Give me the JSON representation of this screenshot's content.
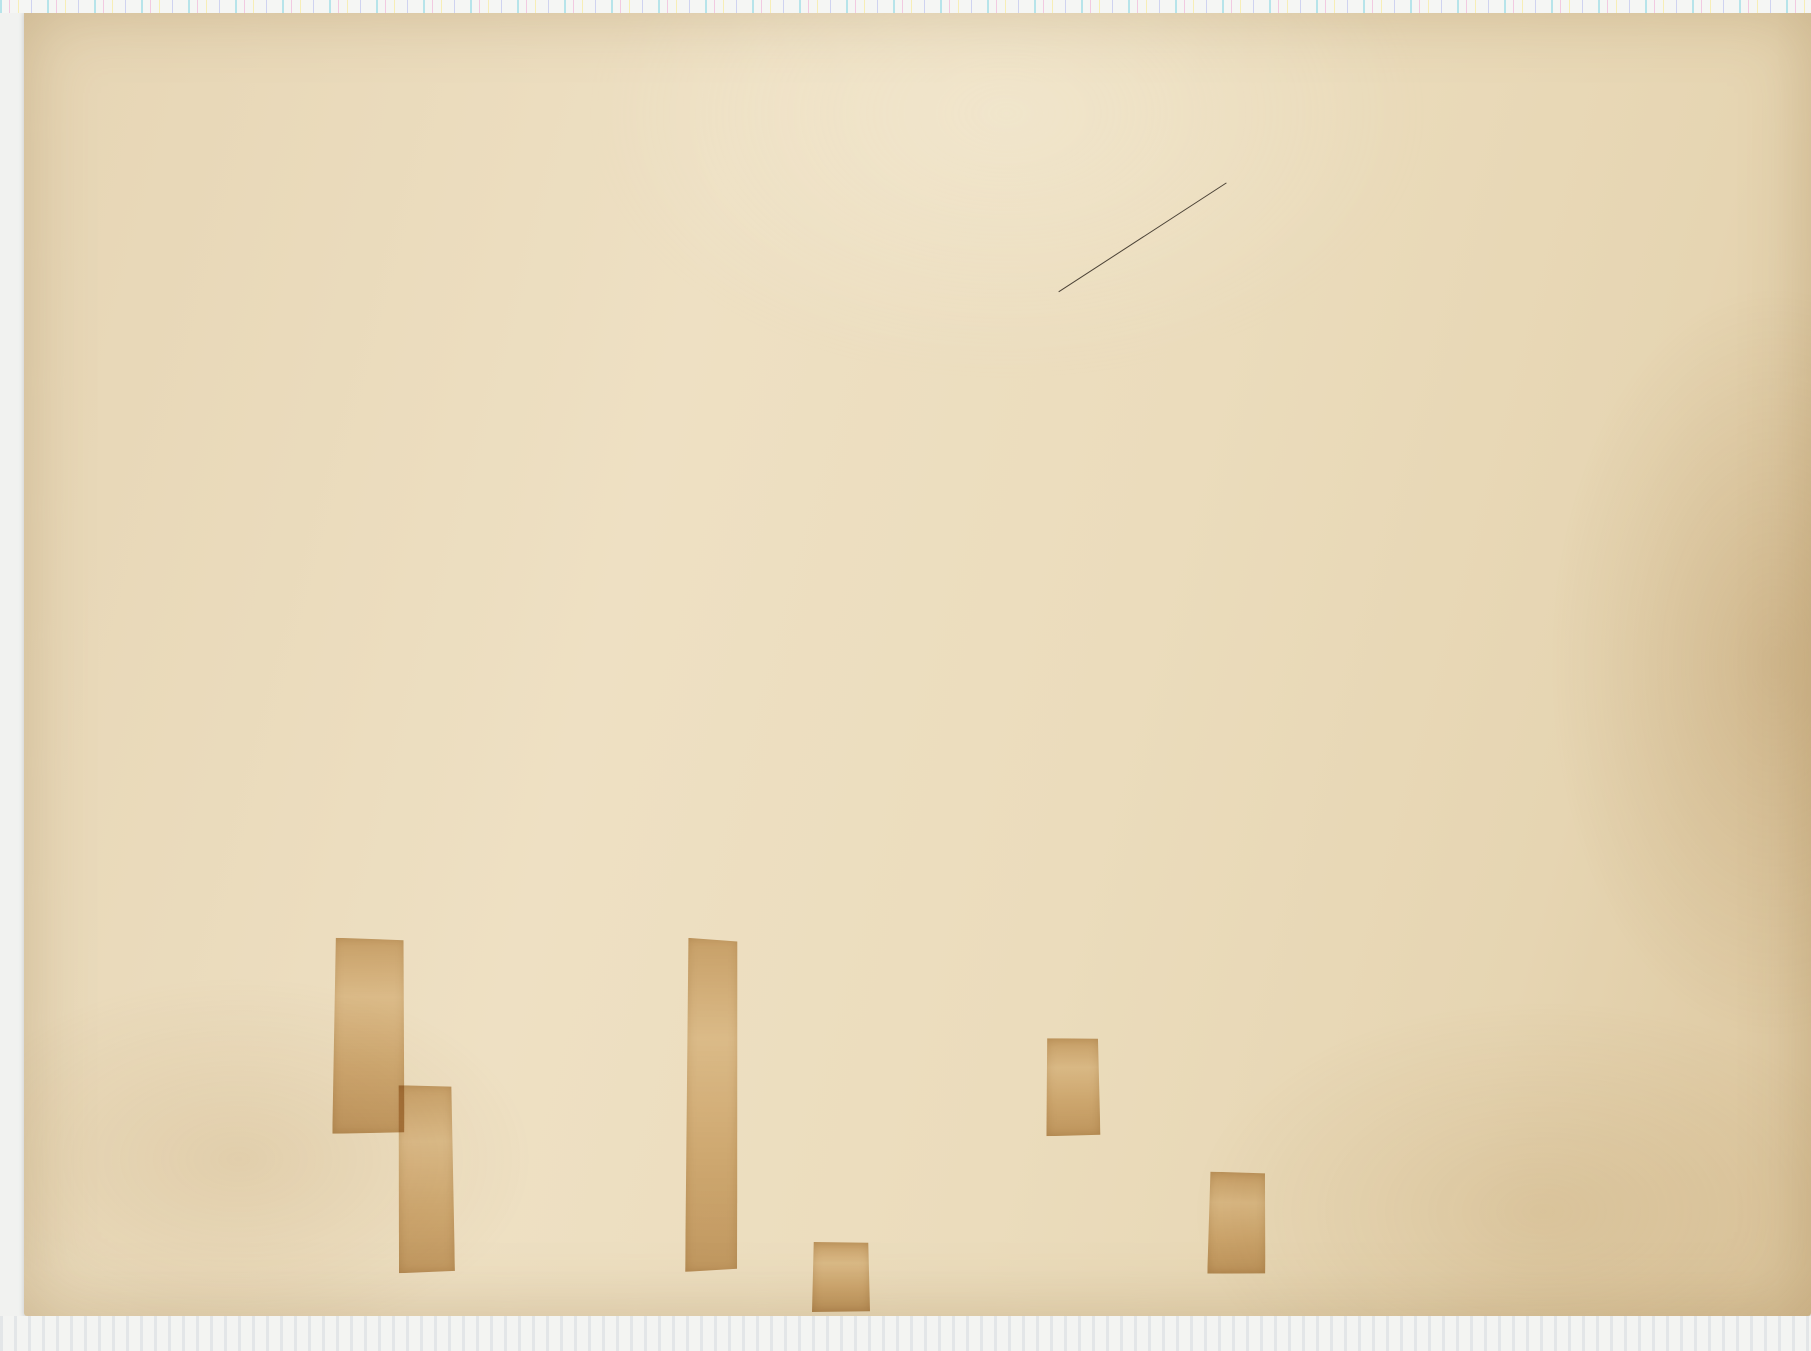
{
  "map": {
    "title_block": {
      "kart": "KART",
      "over": "over",
      "line1": "Österdalens Bataljons nye Exercerplads",
      "paa": "paa",
      "line2": "Grindalsmoen i Elverum,",
      "line3": "kopieret og koteret",
      "af": "af",
      "author": "B. Hjelm",
      "role": "Kompagnichef.",
      "year": "1878."
    },
    "note_diagonal": "Kopi i kontratryk.",
    "labels": {
      "sagstuen": "Sagstuen",
      "compass": "MN",
      "river": "Terningaaen",
      "road": "Fra Hamar til Elverum",
      "railway": "Hamar - Throndhjem - Jernbane",
      "skydeskiver": "Skydeskiver",
      "skydebane": "Skydebane",
      "prof2": "Prof. №2.",
      "prof1": "Prof. №1.",
      "benchmark": "598' over Havet",
      "spot_bottom": "508'"
    },
    "spot_heights": [
      {
        "v": "616.6",
        "x": 220,
        "y": 280,
        "r": -15
      },
      {
        "v": "676",
        "x": 266,
        "y": 181,
        "r": -10
      },
      {
        "v": "692",
        "x": 445,
        "y": 399,
        "r": -15
      },
      {
        "v": "605",
        "x": 482,
        "y": 489,
        "r": -20
      },
      {
        "v": "611",
        "x": 450,
        "y": 527,
        "r": -25
      },
      {
        "v": "658",
        "x": 625,
        "y": 330,
        "r": -12
      },
      {
        "v": "649",
        "x": 560,
        "y": 455,
        "r": -18
      },
      {
        "v": "663",
        "x": 700,
        "y": 710,
        "r": -10
      },
      {
        "v": "672",
        "x": 610,
        "y": 620,
        "r": -14
      }
    ],
    "road_elevations": [
      {
        "v": "637",
        "x": 538,
        "y": 120,
        "r": -65
      },
      {
        "v": "656",
        "x": 563,
        "y": 117,
        "r": -65
      },
      {
        "v": "655",
        "x": 588,
        "y": 114,
        "r": -65
      },
      {
        "v": "654",
        "x": 613,
        "y": 112,
        "r": -65
      },
      {
        "v": "652",
        "x": 681,
        "y": 122,
        "r": -65
      },
      {
        "v": "643",
        "x": 703,
        "y": 126,
        "r": -65
      },
      {
        "v": "640",
        "x": 725,
        "y": 129,
        "r": -65
      },
      {
        "v": "637",
        "x": 747,
        "y": 132,
        "r": -65
      },
      {
        "v": "489",
        "x": 1493,
        "y": 628,
        "r": -68
      },
      {
        "v": "494",
        "x": 1521,
        "y": 645,
        "r": -68
      },
      {
        "v": "498",
        "x": 1543,
        "y": 661,
        "r": -68
      },
      {
        "v": "495",
        "x": 1561,
        "y": 683,
        "r": -68
      },
      {
        "v": "497",
        "x": 1011,
        "y": 955,
        "r": -75
      },
      {
        "v": "499",
        "x": 1130,
        "y": 995,
        "r": -75
      }
    ]
  },
  "scale_bar": {
    "ratio": "1:4000.",
    "unit_label": "2000 Fod",
    "major_labels": [
      "0",
      "400",
      "800",
      "1200",
      "1600"
    ],
    "minor_labels": [
      "400",
      "360",
      "320",
      "280",
      "240",
      "200",
      "160",
      "120",
      "80",
      "40"
    ],
    "height_labels": [
      "40",
      "36",
      "32",
      "28",
      "24",
      "20",
      "16",
      "12",
      "8",
      "4",
      "0"
    ]
  },
  "stamp": {
    "agency": "NORGES GEOGRAFISKE OPMAALING",
    "number": "46"
  },
  "colors": {
    "paper": "#ecdcbf",
    "ink": "#473e32",
    "contour": "#5d5348",
    "stamp": "#3c3c7a",
    "tape": "#c08d45"
  }
}
